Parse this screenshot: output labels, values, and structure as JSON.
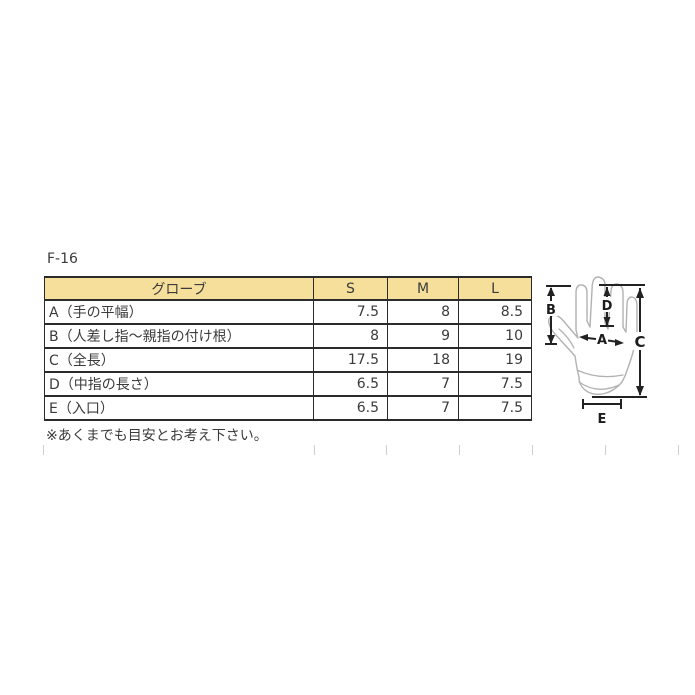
{
  "page": {
    "title": "F-16",
    "note": "※あくまでも目安とお考え下さい。"
  },
  "colors": {
    "header_bg": "#f6df9b",
    "table_border": "#2b2b2b",
    "text": "#3b3b3b",
    "glove_outline": "#b2b2b2",
    "arrow": "#222222"
  },
  "table": {
    "columns": [
      "グローブ",
      "S",
      "M",
      "L"
    ],
    "rows": [
      {
        "label": "A（手の平幅）",
        "s": "7.5",
        "m": "8",
        "l": "8.5"
      },
      {
        "label": "B（人差し指～親指の付け根）",
        "s": "8",
        "m": "9",
        "l": "10"
      },
      {
        "label": "C（全長）",
        "s": "17.5",
        "m": "18",
        "l": "19"
      },
      {
        "label": "D（中指の長さ）",
        "s": "6.5",
        "m": "7",
        "l": "7.5"
      },
      {
        "label": "E（入口）",
        "s": "6.5",
        "m": "7",
        "l": "7.5"
      }
    ]
  },
  "diagram": {
    "labels": {
      "a": "A",
      "b": "B",
      "c": "C",
      "d": "D",
      "e": "E"
    }
  }
}
